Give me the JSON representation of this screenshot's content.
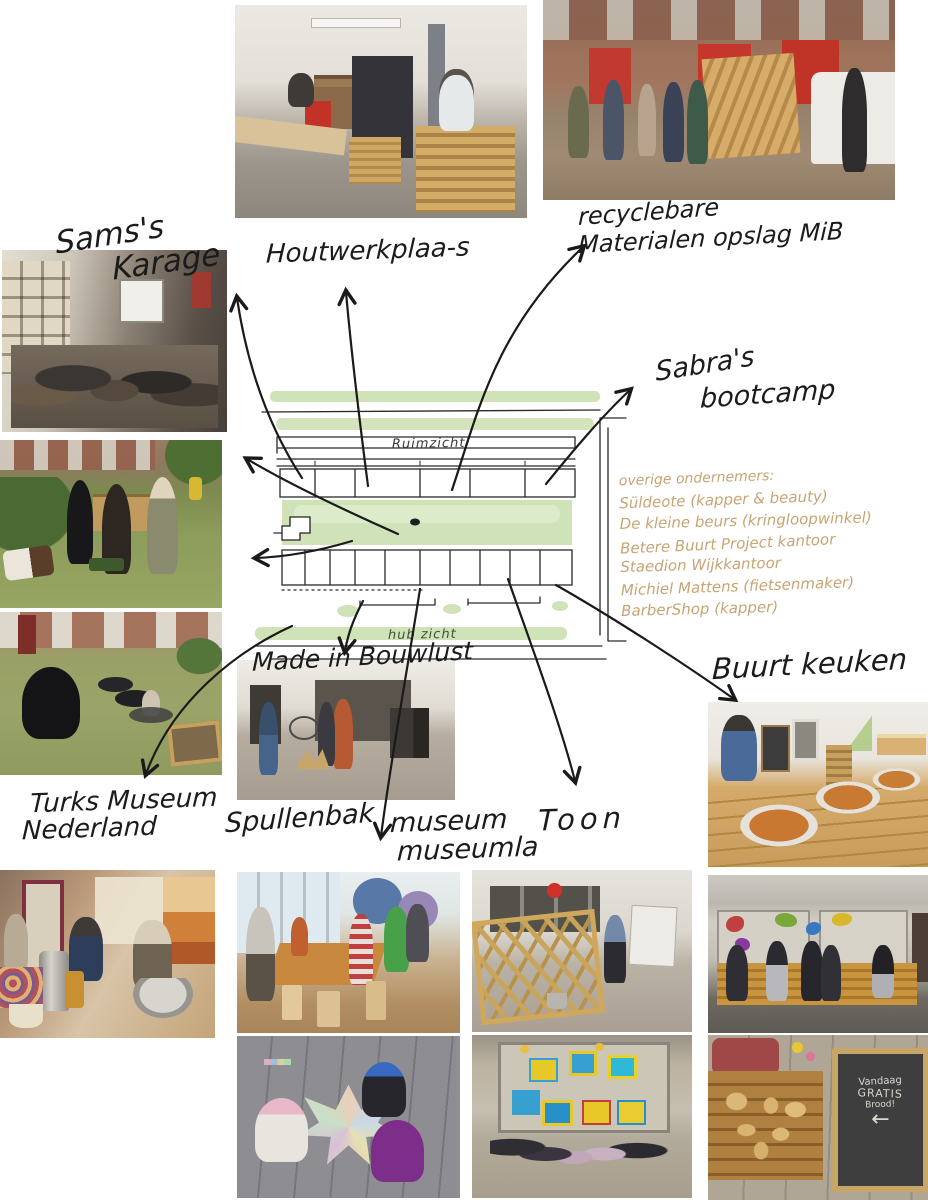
{
  "labels": {
    "sams_garage_line1": "Sams's",
    "sams_garage_line2": "Karage",
    "houtwerkplaats": "Houtwerkplaa-s",
    "recyclebare_line1": "recyclebare",
    "recyclebare_line2": "Materialen opslag MiB",
    "sabras_line1": "Sabra's",
    "sabras_line2": "bootcamp",
    "made_in_bouwlust": "Made in Bouwlust",
    "buurt_keuken": "Buurt keuken",
    "turks_museum_line1": "Turks Museum",
    "turks_museum_line2": "Nederland",
    "spullenbak": "Spullenbak",
    "museum_line1": "museum",
    "museum_line2": "museumla",
    "toon": "Toon"
  },
  "map": {
    "street_top": "Ruimzicht",
    "street_bottom": "hub zicht",
    "highlight_color": "#cfe2b8",
    "ink_color": "#1a1a1a"
  },
  "ondernemers": {
    "title": "overige ondernemers:",
    "color": "#c7a473",
    "items": [
      "Süldeote (kapper & beauty)",
      "De kleine beurs (kringloopwinkel)",
      "Betere Buurt Project kantoor",
      "Staedion Wijkkantoor",
      "Michiel Mattens (fietsenmaker)",
      "BarberShop (kapper)"
    ]
  },
  "chalkboard": {
    "line1": "Vandaag",
    "line2": "GRATIS",
    "line3": "Brood!",
    "arrow": "←"
  }
}
